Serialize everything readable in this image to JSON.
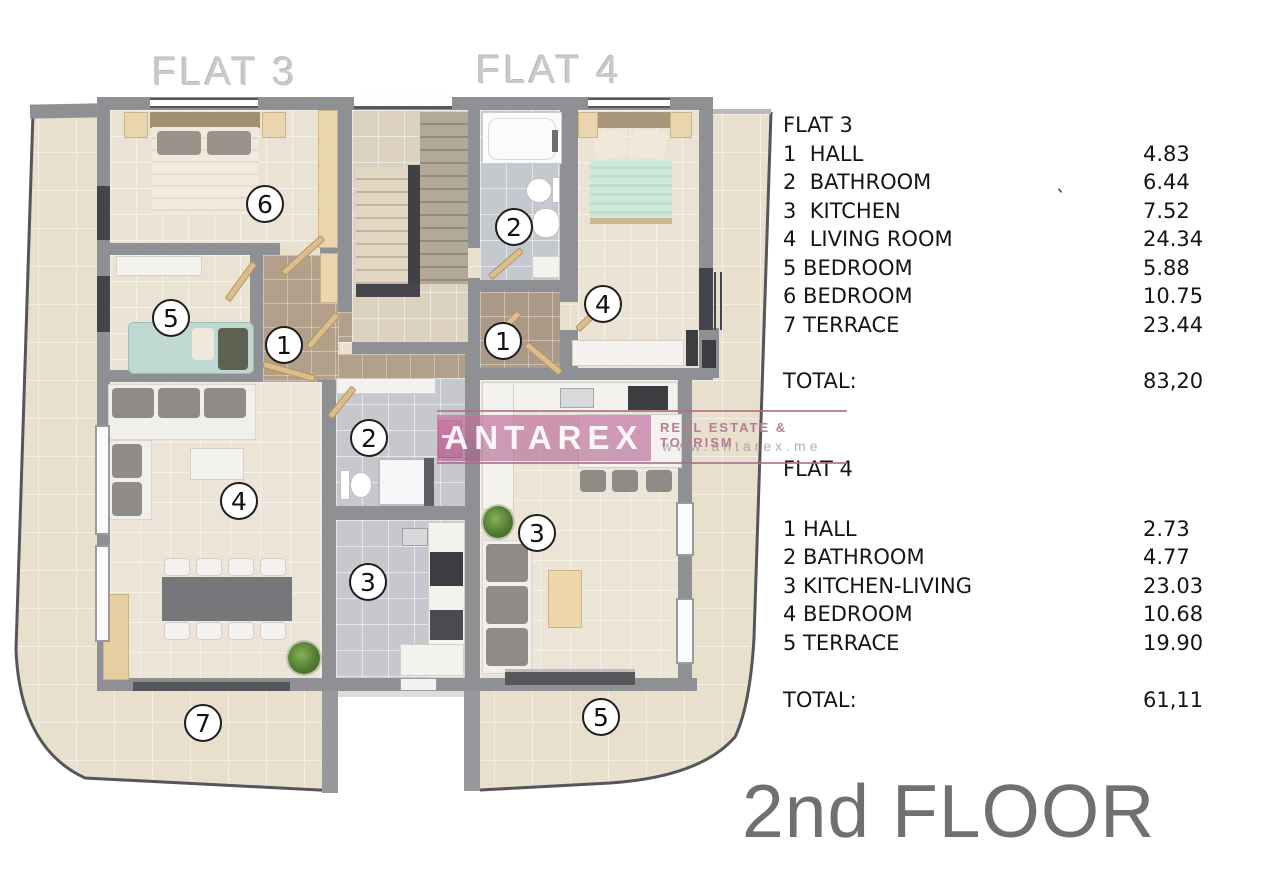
{
  "plan": {
    "flat3_label": "FLAT 3",
    "flat4_label": "FLAT 4",
    "markers": {
      "f3_6": "6",
      "f3_5": "5",
      "f3_1": "1",
      "f3_2": "2",
      "f3_4": "4",
      "f3_3": "3",
      "f3_7": "7",
      "f4_2": "2",
      "f4_4": "4",
      "f4_1": "1",
      "f4_3": "3",
      "f4_5": "5"
    }
  },
  "watermark": {
    "brand": "ANTAREX",
    "tagline": "REAL ESTATE & TOURISM",
    "url": "www.antarex.me",
    "band_color": "#c474a0"
  },
  "panel": {
    "flat3": {
      "title": "FLAT 3",
      "rooms": [
        {
          "label": "1  HALL",
          "area": "4.83"
        },
        {
          "label": "2  BATHROOM",
          "area": "6.44"
        },
        {
          "label": "3  KITCHEN",
          "area": "7.52"
        },
        {
          "label": "4  LIVING ROOM",
          "area": "24.34"
        },
        {
          "label": "5 BEDROOM",
          "area": "5.88"
        },
        {
          "label": "6 BEDROOM",
          "area": "10.75"
        },
        {
          "label": "7 TERRACE",
          "area": "23.44"
        }
      ],
      "total_label": "TOTAL:",
      "total": "83,20"
    },
    "flat4": {
      "title": "FLAT 4",
      "rooms": [
        {
          "label": "1 HALL",
          "area": "2.73"
        },
        {
          "label": "2 BATHROOM",
          "area": "4.77"
        },
        {
          "label": "3 KITCHEN-LIVING",
          "area": "23.03"
        },
        {
          "label": "4 BEDROOM",
          "area": "10.68"
        },
        {
          "label": "5 TERRACE",
          "area": "19.90"
        }
      ],
      "total_label": "TOTAL:",
      "total": "61,11"
    },
    "stray_mark": "`"
  },
  "footer": {
    "floor_label": "2nd FLOOR"
  }
}
